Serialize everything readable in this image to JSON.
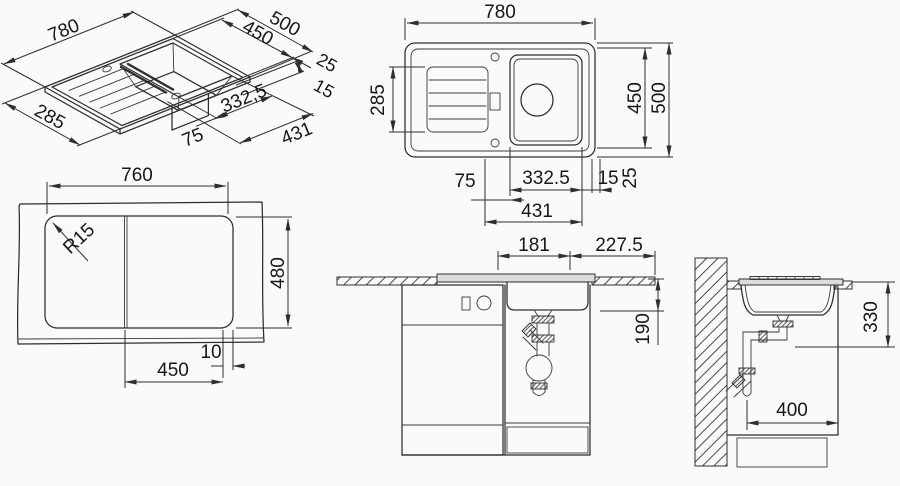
{
  "drawing": {
    "type": "technical-dimension-drawing",
    "subject": "kitchen sink with drainboard, plan, isometric, cutout and installation sections",
    "units": "mm"
  },
  "colors": {
    "line": "#2e2e2e",
    "background": "#fafafa",
    "fill_light": "#dcdcdc"
  },
  "views": {
    "isometric": {
      "labels": {
        "width": "780",
        "depth": "500",
        "inner_depth": "450",
        "edge": "25",
        "rim": "15",
        "drainer_depth": "285",
        "bowl_width": "332,5",
        "offset": "75",
        "cutout_width": "431"
      }
    },
    "plan": {
      "labels": {
        "width": "780",
        "drainer_depth": "285",
        "inner_depth": "450",
        "depth": "500",
        "offset": "75",
        "bowl_width": "332.5",
        "rim": "15",
        "edge": "25",
        "cutout_width": "431"
      }
    },
    "front": {
      "labels": {
        "cutout_width": "760",
        "corner_radius": "R15",
        "cutout_depth": "480",
        "edge_gap": "10",
        "divider_offset": "450"
      }
    },
    "cabinet_section": {
      "labels": {
        "bowl_center_left": "181",
        "bowl_center_right": "227.5",
        "drain_depth": "190"
      }
    },
    "wall_section": {
      "labels": {
        "install_depth": "330",
        "cabinet_clearance": "400"
      }
    }
  }
}
